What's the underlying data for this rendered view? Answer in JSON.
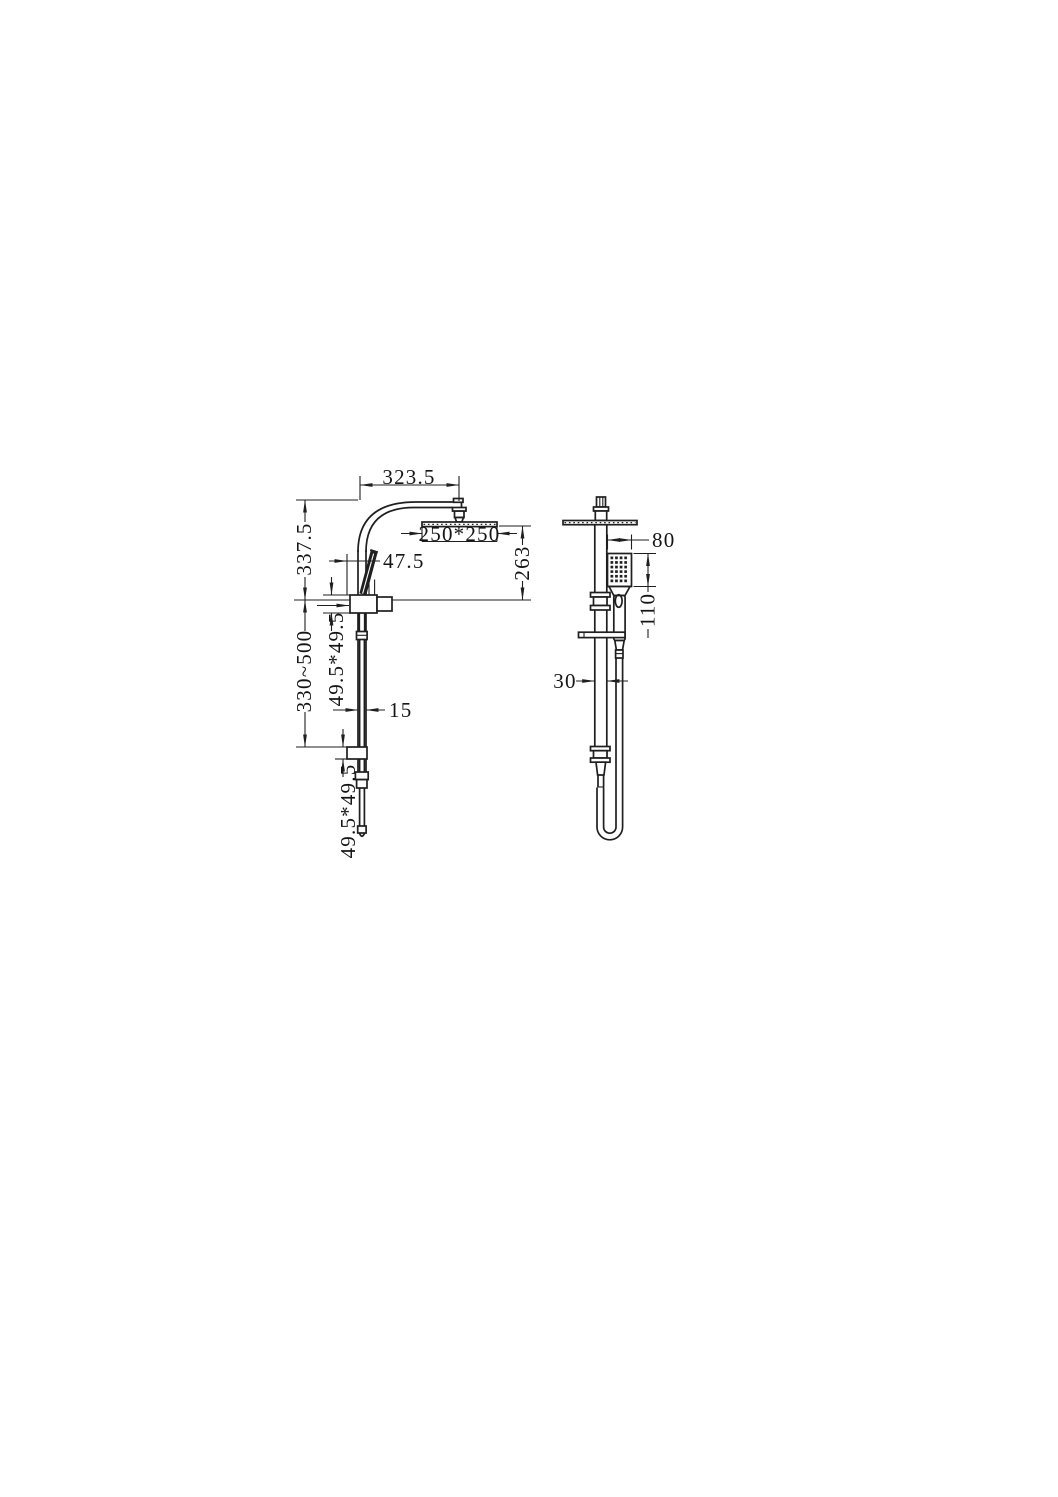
{
  "drawing": {
    "colors": {
      "line": "#1f1f1f",
      "background": "#ffffff"
    },
    "front_view": {
      "dims": {
        "arm_reach": "323.5",
        "upper_height": "337.5",
        "head_size": "250*250",
        "head_drop": "263",
        "handset_offset": "47.5",
        "upper_bracket": "49.5*49.5",
        "adjust_range": "330~500",
        "rail_width": "15",
        "lower_bracket": "49.5*49.5"
      }
    },
    "side_view": {
      "dims": {
        "handset_width": "80",
        "handset_length": "110",
        "rail_depth": "30"
      }
    }
  }
}
